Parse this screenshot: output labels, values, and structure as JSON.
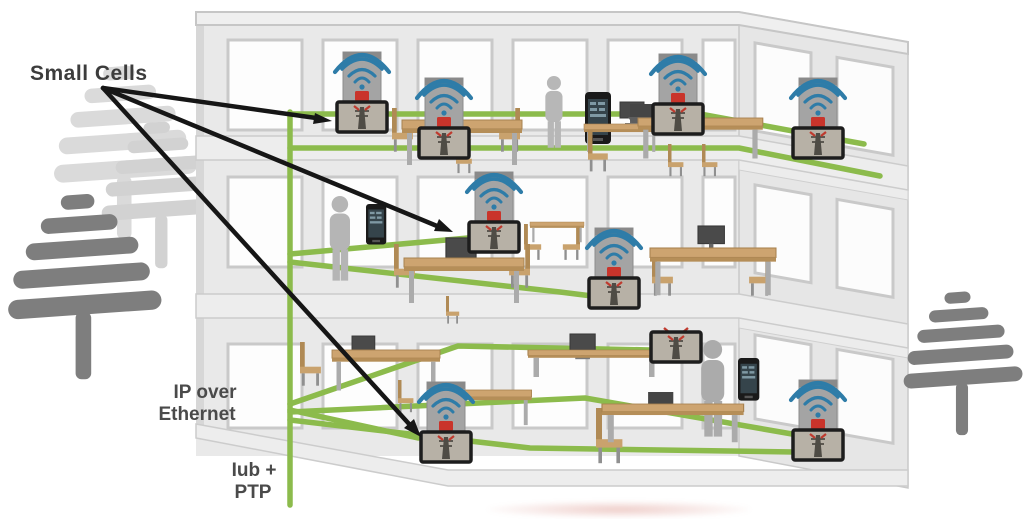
{
  "labels": {
    "small_cells": "Small Cells",
    "ip_over_line1": "IP over",
    "ip_over_line2": "Ethernet",
    "iub_ptp_line1": "Iub +",
    "iub_ptp_line2": "PTP"
  },
  "colors": {
    "ethernet_green": "#8cbb4c",
    "wifi_blue": "#2e7ca8",
    "small_cell_red": "#c9342b",
    "arrow_black": "#161616",
    "building_wall": "#e9e9e9",
    "building_edge": "#c6c6c6",
    "tree_dark": "#7e7e7e",
    "tree_light": "#d9d9d9",
    "desk_tan": "#cda470",
    "label_text": "#3c3c3c"
  },
  "icons": {
    "wifi": "concentric blue signal arcs",
    "small_cell": "gray access-point box with framed cell-tower picture",
    "tree": "stylized pine silhouette",
    "person": "gray human silhouette",
    "smartphone": "black handset with app screen",
    "arrow": "black callout arrow"
  },
  "counts": {
    "floors": 3,
    "small_cells_total": 9,
    "callout_arrows": 3
  }
}
